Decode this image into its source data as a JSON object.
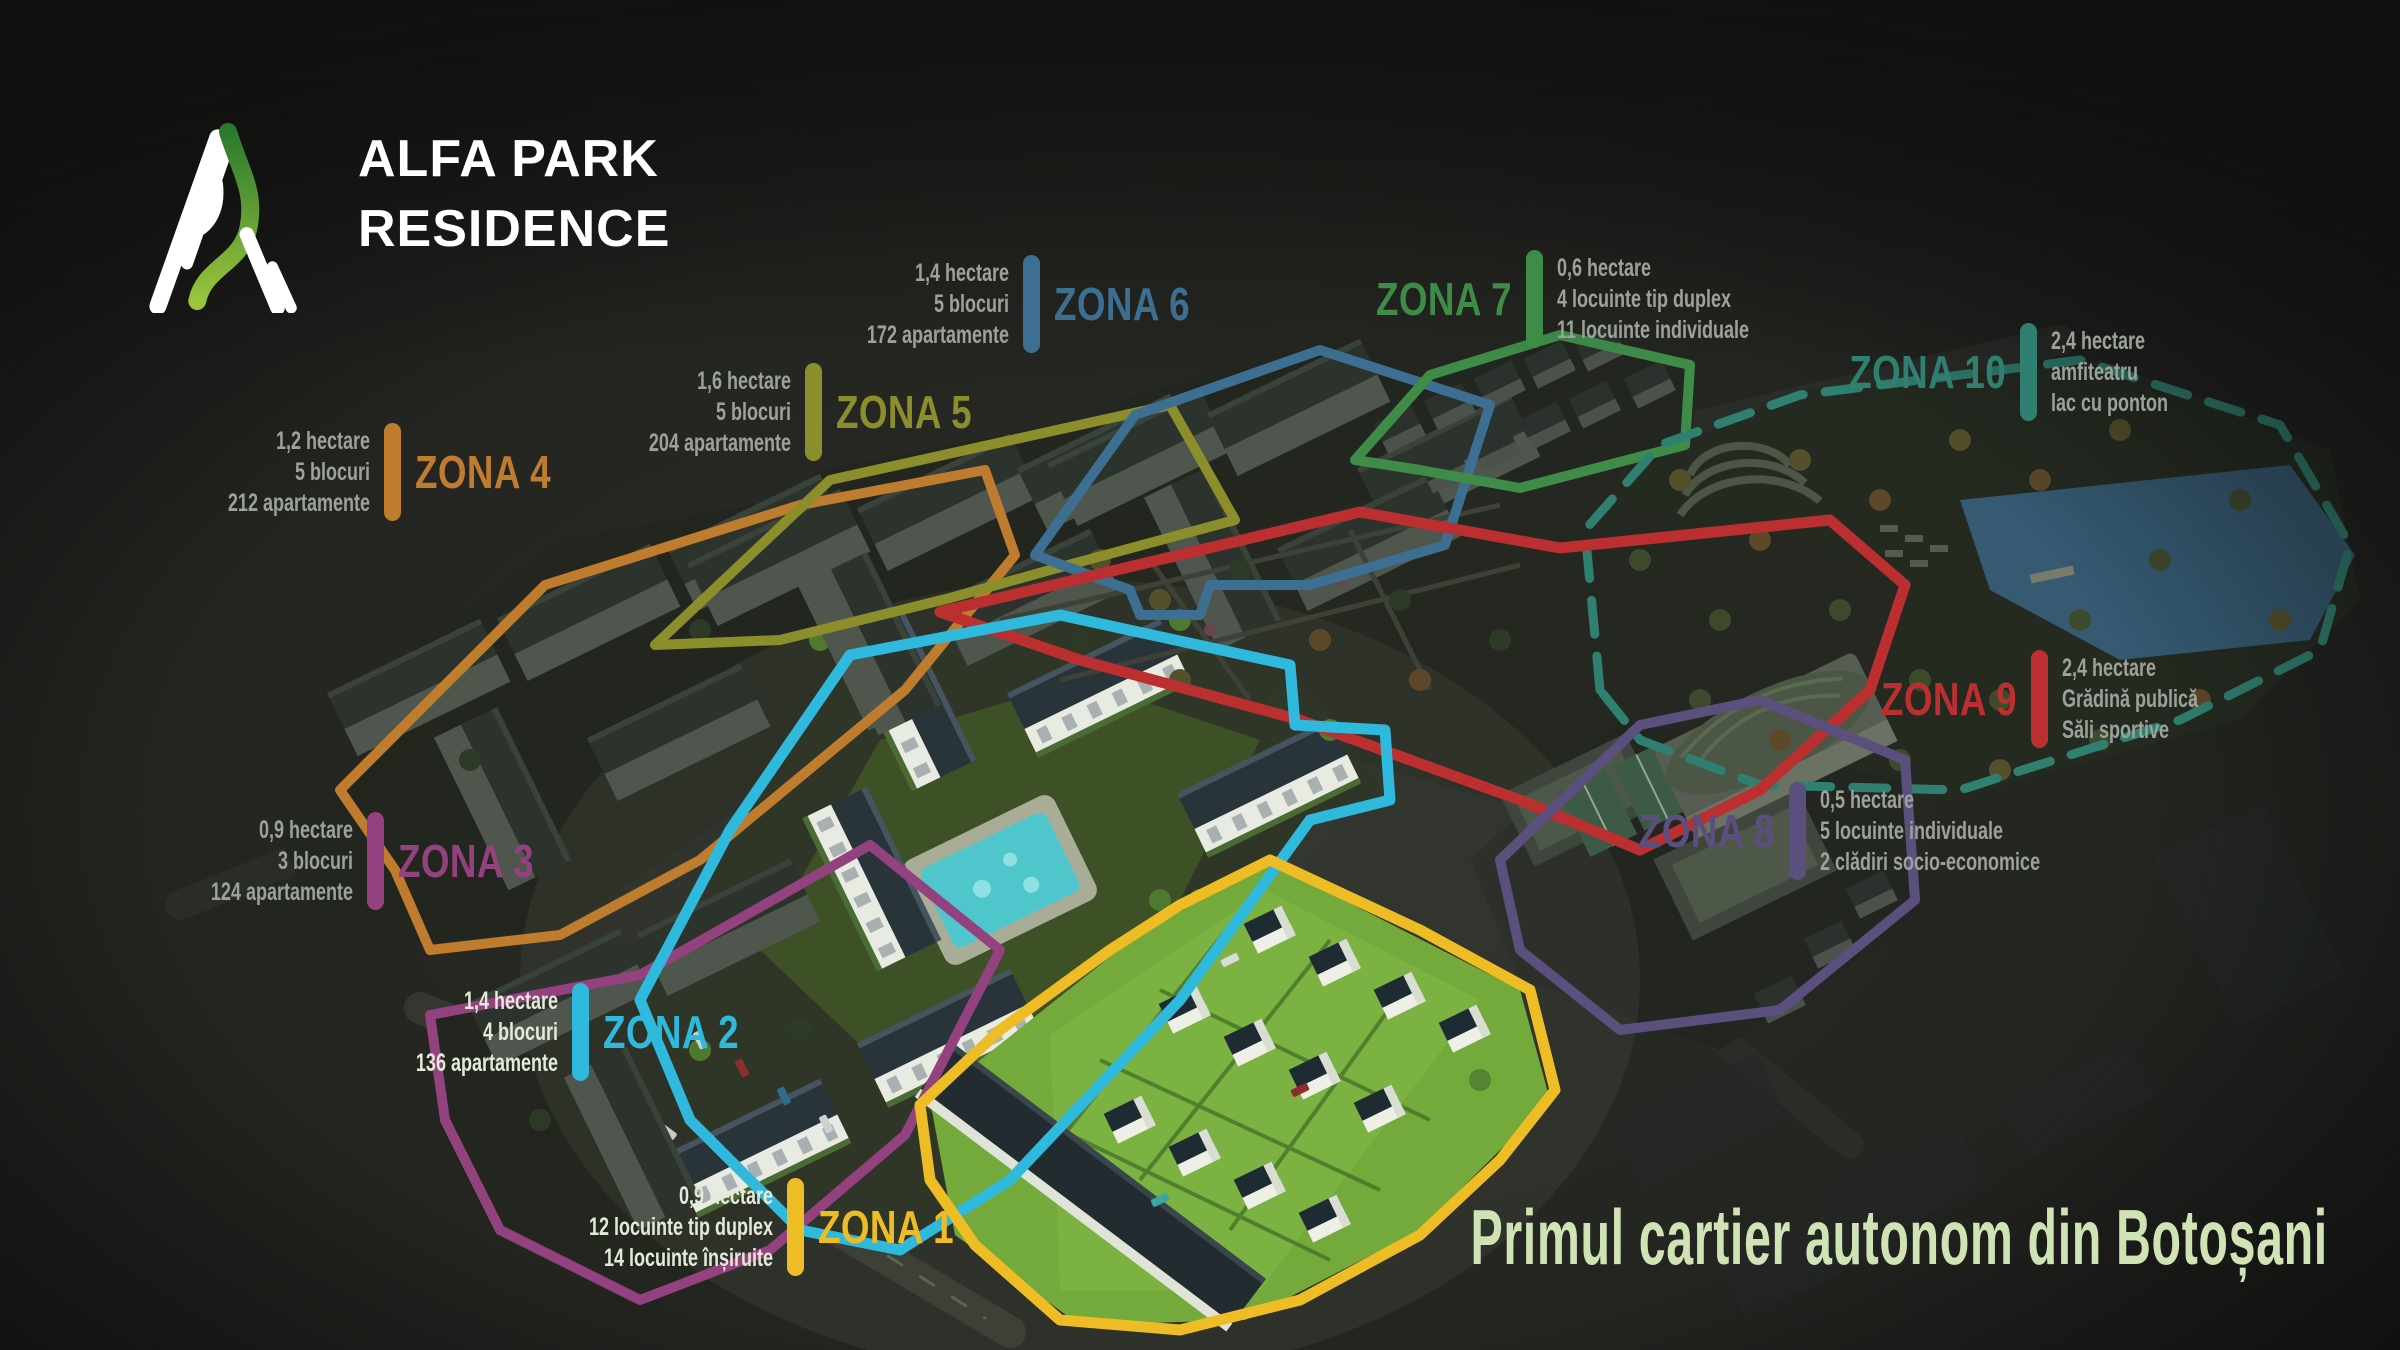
{
  "logo": {
    "line1": "ALFA PARK",
    "line2": "RESIDENCE",
    "ribbon_from": "#2a7a2e",
    "ribbon_to": "#9ac43c"
  },
  "tagline": {
    "text": "Primul cartier autonom din Botoșani",
    "color": "#cfe3b4"
  },
  "zones": [
    {
      "name": "ZONA 1",
      "color": "#eebc25",
      "stats": [
        "0,9 hectare",
        "12 locuinte tip duplex",
        "14 locuinte înșiruite"
      ]
    },
    {
      "name": "ZONA 2",
      "color": "#2fb9dc",
      "stats": [
        "1,4 hectare",
        "4 blocuri",
        "136 apartamente"
      ]
    },
    {
      "name": "ZONA 3",
      "color": "#93417f",
      "stats": [
        "0,9 hectare",
        "3 blocuri",
        "124 apartamente"
      ]
    },
    {
      "name": "ZONA 4",
      "color": "#bf7c2e",
      "stats": [
        "1,2 hectare",
        "5 blocuri",
        "212 apartamente"
      ]
    },
    {
      "name": "ZONA 5",
      "color": "#8b8e2b",
      "stats": [
        "1,6 hectare",
        "5 blocuri",
        "204 apartamente"
      ]
    },
    {
      "name": "ZONA 6",
      "color": "#3d6f92",
      "stats": [
        "1,4 hectare",
        "5 blocuri",
        "172 apartamente"
      ]
    },
    {
      "name": "ZONA 7",
      "color": "#3f8c49",
      "stats": [
        "0,6 hectare",
        "4 locuinte tip duplex",
        "11 locuinte individuale"
      ]
    },
    {
      "name": "ZONA 8",
      "color": "#5b4f7e",
      "stats": [
        "0,5 hectare",
        "5 locuinte individuale",
        "2 clădiri socio-economice"
      ]
    },
    {
      "name": "ZONA 9",
      "color": "#bb2f31",
      "stats": [
        "2,4 hectare",
        "Grădină publică",
        "Săli sportive"
      ]
    },
    {
      "name": "ZONA 10",
      "color": "#2f8070",
      "stats": [
        "2,4 hectare",
        "amfiteatru",
        "lac cu ponton"
      ]
    }
  ]
}
